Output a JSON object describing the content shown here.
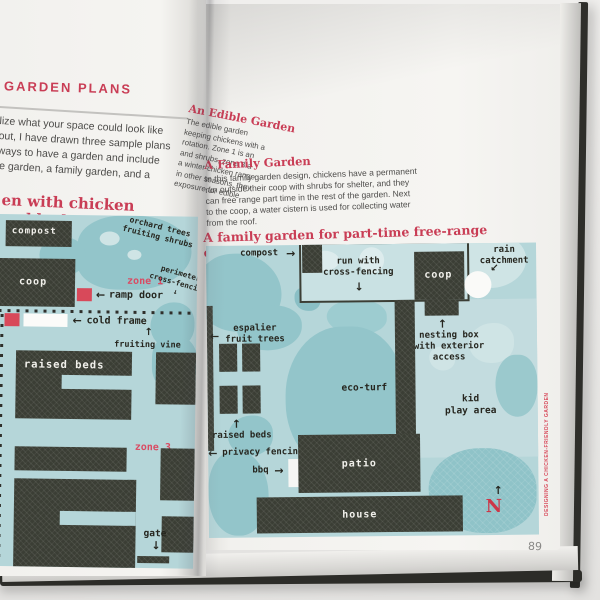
{
  "photo": {
    "page_number": "89",
    "spine_text": "DESIGNING A CHICKEN-FRIENDLY GARDEN"
  },
  "glyphs": {
    "arrow_left": "←",
    "arrow_right": "→",
    "arrow_up": "↑",
    "arrow_down": "↓",
    "arrow_down_left": "↙"
  },
  "left_page": {
    "heading": "GARDEN PLANS",
    "intro_lines": [
      "lize what your space could look like",
      "out, I have drawn three sample plans",
      "ways to have a garden and include",
      "le garden, a family garden, and a"
    ],
    "diagram_title": "en with chicken paddocks",
    "diagram": {
      "compost": "compost",
      "coop": "coop",
      "zone_1": "zone 1",
      "ramp_door": "ramp door",
      "cold_frame": "cold frame",
      "orchard_line1": "orchard trees",
      "orchard_line2": "fruiting shrubs",
      "perimeter_line1": "perimeter",
      "perimeter_line2": "cross-fencing",
      "fruiting_vine": "fruiting vine",
      "raised_beds": "raised beds",
      "zone_3": "zone 3",
      "gate": "gate"
    }
  },
  "right_page": {
    "edible_heading": "An Edible Garden",
    "edible_lines": [
      "The edible garden",
      "keeping chickens with a",
      "rotation. Zone 1 is an",
      "and shrubs, zone 3 a",
      "a winter chicken range",
      "in other seasons, they",
      "exposure for edible"
    ],
    "family_heading": "A Family Garden",
    "family_lines": [
      "In this family garden design, chickens have a permanent",
      "run outside their coop with shrubs for shelter, and they",
      "can free range part time in the rest of the garden. Next",
      "to the coop, a water cistern is used for collecting water",
      "from the roof."
    ],
    "diagram_title": "A family garden for part-time free-range chickens",
    "diagram": {
      "compost": "compost",
      "run_line1": "run with",
      "run_line2": "cross-fencing",
      "coop": "coop",
      "rain_line1": "rain",
      "rain_line2": "catchment",
      "nesting_line1": "nesting box",
      "nesting_line2": "with exterior",
      "nesting_line3": "access",
      "espalier_line1": "espalier",
      "espalier_line2": "fruit trees",
      "eco_turf": "eco-turf",
      "kid_line1": "kid",
      "kid_line2": "play area",
      "raised_beds": "raised beds",
      "privacy_fencing": "privacy fencing",
      "bbq": "bbq",
      "patio": "patio",
      "house": "house",
      "compass": "N"
    }
  },
  "palette": {
    "accent_red": "#c93d55",
    "label_red": "#d94b63",
    "diagram_blue": "#b5d6d9",
    "shrub_teal": "#93c5ca",
    "dark_structure": "#3b3e35",
    "page_white": "#f4f3f0"
  }
}
